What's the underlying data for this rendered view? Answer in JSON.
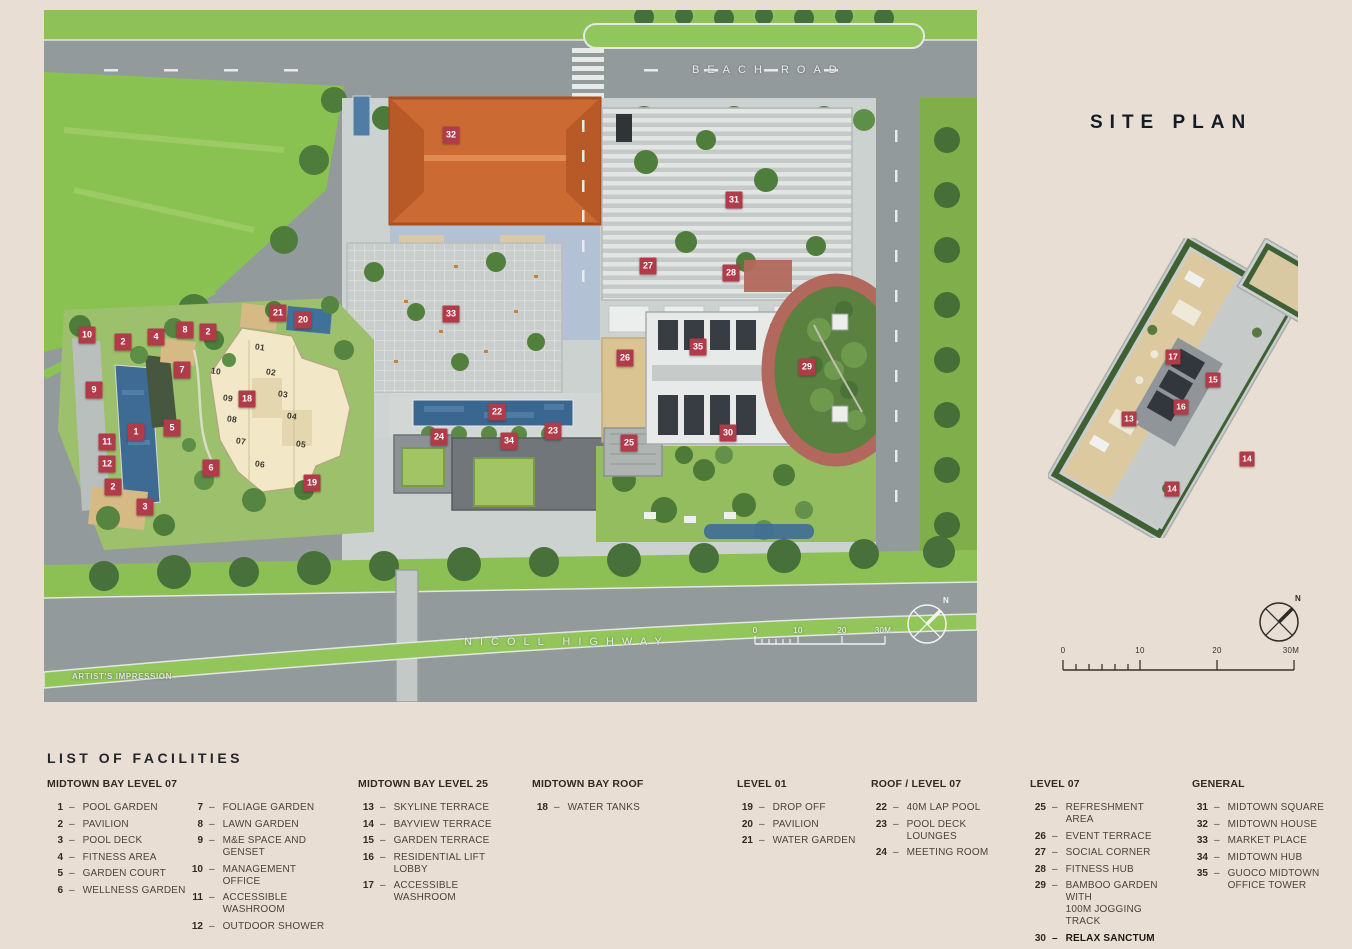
{
  "page": {
    "background": "#e8ded3",
    "accent": "#b23b49",
    "ink": "#121c29"
  },
  "rightPanel": {
    "title": "SITE PLAN"
  },
  "map": {
    "roadTop": "BEACH ROAD",
    "roadBottom": "NICOLL HIGHWAY",
    "caption": "ARTIST'S IMPRESSION",
    "compassLabel": "N",
    "scaleTicks": [
      "0",
      "10",
      "20",
      "30M"
    ],
    "markers": [
      {
        "n": "10",
        "x": 43,
        "y": 325
      },
      {
        "n": "2",
        "x": 79,
        "y": 332
      },
      {
        "n": "4",
        "x": 112,
        "y": 327
      },
      {
        "n": "8",
        "x": 141,
        "y": 320
      },
      {
        "n": "2",
        "x": 164,
        "y": 322
      },
      {
        "n": "21",
        "x": 234,
        "y": 303
      },
      {
        "n": "20",
        "x": 259,
        "y": 310
      },
      {
        "n": "9",
        "x": 50,
        "y": 380
      },
      {
        "n": "7",
        "x": 138,
        "y": 360
      },
      {
        "n": "1",
        "x": 92,
        "y": 422
      },
      {
        "n": "5",
        "x": 128,
        "y": 418
      },
      {
        "n": "11",
        "x": 63,
        "y": 432
      },
      {
        "n": "12",
        "x": 63,
        "y": 454
      },
      {
        "n": "2",
        "x": 69,
        "y": 477
      },
      {
        "n": "3",
        "x": 101,
        "y": 497
      },
      {
        "n": "6",
        "x": 167,
        "y": 458
      },
      {
        "n": "18",
        "x": 203,
        "y": 389
      },
      {
        "n": "19",
        "x": 268,
        "y": 473
      },
      {
        "n": "32",
        "x": 407,
        "y": 125
      },
      {
        "n": "33",
        "x": 407,
        "y": 304
      },
      {
        "n": "22",
        "x": 453,
        "y": 402
      },
      {
        "n": "24",
        "x": 395,
        "y": 427
      },
      {
        "n": "34",
        "x": 465,
        "y": 431
      },
      {
        "n": "23",
        "x": 509,
        "y": 421
      },
      {
        "n": "25",
        "x": 585,
        "y": 433
      },
      {
        "n": "26",
        "x": 581,
        "y": 348
      },
      {
        "n": "35",
        "x": 654,
        "y": 337
      },
      {
        "n": "27",
        "x": 604,
        "y": 256
      },
      {
        "n": "28",
        "x": 687,
        "y": 263
      },
      {
        "n": "31",
        "x": 690,
        "y": 190
      },
      {
        "n": "29",
        "x": 763,
        "y": 357
      },
      {
        "n": "30",
        "x": 684,
        "y": 423
      }
    ],
    "unitLabels": [
      {
        "n": "01",
        "x": 216,
        "y": 337
      },
      {
        "n": "02",
        "x": 227,
        "y": 362
      },
      {
        "n": "03",
        "x": 239,
        "y": 384
      },
      {
        "n": "04",
        "x": 248,
        "y": 406
      },
      {
        "n": "05",
        "x": 257,
        "y": 434
      },
      {
        "n": "06",
        "x": 216,
        "y": 454
      },
      {
        "n": "07",
        "x": 197,
        "y": 431
      },
      {
        "n": "08",
        "x": 188,
        "y": 409
      },
      {
        "n": "09",
        "x": 184,
        "y": 388
      },
      {
        "n": "10",
        "x": 172,
        "y": 361
      }
    ]
  },
  "inset": {
    "compassLabel": "N",
    "scaleTicks": [
      "0",
      "10",
      "20",
      "30M"
    ],
    "markers": [
      {
        "n": "17",
        "x": 125,
        "y": 119
      },
      {
        "n": "15",
        "x": 165,
        "y": 142
      },
      {
        "n": "16",
        "x": 133,
        "y": 169
      },
      {
        "n": "13",
        "x": 81,
        "y": 181
      },
      {
        "n": "14",
        "x": 199,
        "y": 221
      },
      {
        "n": "14",
        "x": 124,
        "y": 251
      }
    ]
  },
  "legend": {
    "title": "LIST OF FACILITIES",
    "dash": "–",
    "groups": [
      {
        "heading": "MIDTOWN BAY LEVEL 07",
        "columns": [
          [
            {
              "n": "1",
              "label": "POOL GARDEN"
            },
            {
              "n": "2",
              "label": "PAVILION"
            },
            {
              "n": "3",
              "label": "POOL DECK"
            },
            {
              "n": "4",
              "label": "FITNESS AREA"
            },
            {
              "n": "5",
              "label": "GARDEN COURT"
            },
            {
              "n": "6",
              "label": "WELLNESS GARDEN"
            }
          ],
          [
            {
              "n": "7",
              "label": "FOLIAGE GARDEN"
            },
            {
              "n": "8",
              "label": "LAWN GARDEN"
            },
            {
              "n": "9",
              "label": "M&E SPACE AND GENSET"
            },
            {
              "n": "10",
              "label": "MANAGEMENT OFFICE"
            },
            {
              "n": "11",
              "label": "ACCESSIBLE WASHROOM"
            },
            {
              "n": "12",
              "label": "OUTDOOR SHOWER"
            }
          ]
        ]
      },
      {
        "heading": "MIDTOWN BAY LEVEL 25",
        "columns": [
          [
            {
              "n": "13",
              "label": "SKYLINE TERRACE"
            },
            {
              "n": "14",
              "label": "BAYVIEW TERRACE"
            },
            {
              "n": "15",
              "label": "GARDEN TERRACE"
            },
            {
              "n": "16",
              "label": "RESIDENTIAL LIFT LOBBY"
            },
            {
              "n": "17",
              "label": "ACCESSIBLE WASHROOM"
            }
          ]
        ]
      },
      {
        "heading": "MIDTOWN BAY ROOF",
        "columns": [
          [
            {
              "n": "18",
              "label": "WATER TANKS"
            }
          ]
        ]
      },
      {
        "heading": "LEVEL 01",
        "columns": [
          [
            {
              "n": "19",
              "label": "DROP OFF"
            },
            {
              "n": "20",
              "label": "PAVILION"
            },
            {
              "n": "21",
              "label": "WATER GARDEN"
            }
          ]
        ]
      },
      {
        "heading": "ROOF / LEVEL 07",
        "columns": [
          [
            {
              "n": "22",
              "label": "40M LAP POOL"
            },
            {
              "n": "23",
              "label": "POOL DECK LOUNGES"
            },
            {
              "n": "24",
              "label": "MEETING ROOM"
            }
          ]
        ]
      },
      {
        "heading": "LEVEL 07",
        "columns": [
          [
            {
              "n": "25",
              "label": "REFRESHMENT AREA"
            },
            {
              "n": "26",
              "label": "EVENT TERRACE"
            },
            {
              "n": "27",
              "label": "SOCIAL CORNER"
            },
            {
              "n": "28",
              "label": "FITNESS HUB"
            },
            {
              "n": "29",
              "label": "BAMBOO GARDEN WITH\n100M JOGGING TRACK"
            },
            {
              "n": "30",
              "label": "RELAX SANCTUM",
              "bold": true
            }
          ]
        ]
      },
      {
        "heading": "GENERAL",
        "columns": [
          [
            {
              "n": "31",
              "label": "MIDTOWN SQUARE"
            },
            {
              "n": "32",
              "label": "MIDTOWN HOUSE"
            },
            {
              "n": "33",
              "label": "MARKET PLACE"
            },
            {
              "n": "34",
              "label": "MIDTOWN HUB"
            },
            {
              "n": "35",
              "label": "GUOCO MIDTOWN\nOFFICE TOWER"
            }
          ]
        ]
      }
    ]
  }
}
